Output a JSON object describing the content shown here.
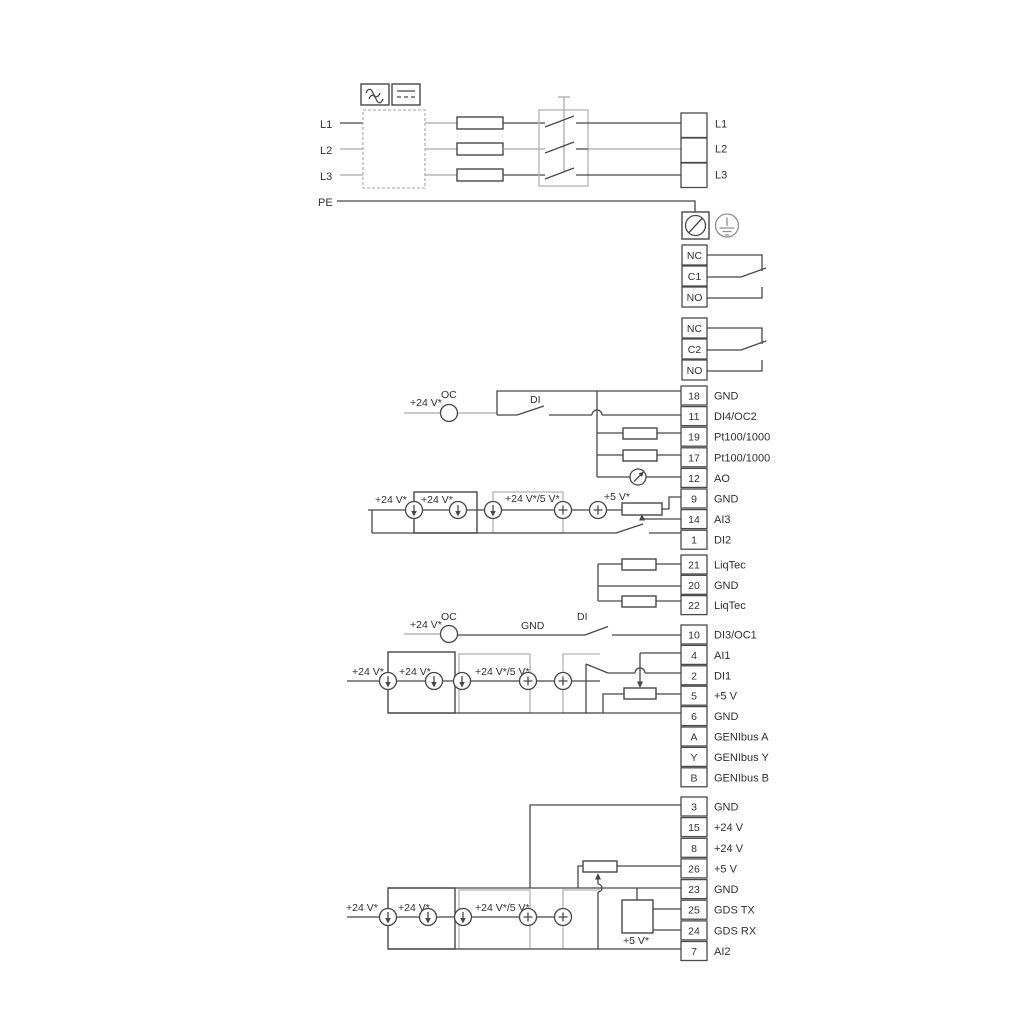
{
  "power": {
    "left": [
      "L1",
      "L2",
      "L3",
      "PE"
    ],
    "right": [
      "L1",
      "L2",
      "L3"
    ]
  },
  "relays": {
    "relay1": [
      "NC",
      "C1",
      "NO"
    ],
    "relay2": [
      "NC",
      "C2",
      "NO"
    ]
  },
  "io1": {
    "rows": [
      {
        "num": "18",
        "label": "GND"
      },
      {
        "num": "11",
        "label": "DI4/OC2"
      },
      {
        "num": "19",
        "label": "Pt100/1000"
      },
      {
        "num": "17",
        "label": "Pt100/1000"
      },
      {
        "num": "12",
        "label": "AO"
      },
      {
        "num": "9",
        "label": "GND"
      },
      {
        "num": "14",
        "label": "AI3"
      },
      {
        "num": "1",
        "label": "DI2"
      }
    ]
  },
  "liqtec": {
    "rows": [
      {
        "num": "21",
        "label": "LiqTec"
      },
      {
        "num": "20",
        "label": "GND"
      },
      {
        "num": "22",
        "label": "LiqTec"
      }
    ]
  },
  "io2": {
    "rows": [
      {
        "num": "10",
        "label": "DI3/OC1"
      },
      {
        "num": "4",
        "label": "AI1"
      },
      {
        "num": "2",
        "label": "DI1"
      },
      {
        "num": "5",
        "label": "+5 V"
      },
      {
        "num": "6",
        "label": "GND"
      },
      {
        "num": "A",
        "label": "GENIbus A"
      },
      {
        "num": "Y",
        "label": "GENIbus Y"
      },
      {
        "num": "B",
        "label": "GENIbus B"
      }
    ]
  },
  "io3": {
    "rows": [
      {
        "num": "3",
        "label": "GND"
      },
      {
        "num": "15",
        "label": "+24 V"
      },
      {
        "num": "8",
        "label": "+24 V"
      },
      {
        "num": "26",
        "label": "+5 V"
      },
      {
        "num": "23",
        "label": "GND"
      },
      {
        "num": "25",
        "label": "GDS TX"
      },
      {
        "num": "24",
        "label": "GDS RX"
      },
      {
        "num": "7",
        "label": "AI2"
      }
    ]
  },
  "ann": {
    "c1": {
      "v24": "+24 V*",
      "oc": "OC",
      "di": "DI"
    },
    "ai3": {
      "v24a": "+24 V*",
      "v24b": "+24 V*",
      "v245": "+24 V*/5 V*",
      "v5": "+5 V*"
    },
    "c3": {
      "v24": "+24 V*",
      "oc": "OC",
      "gnd": "GND",
      "di": "DI"
    },
    "ai1": {
      "v24a": "+24 V*",
      "v24b": "+24 V*",
      "v245": "+24 V*/5 V*"
    },
    "ai2": {
      "v24a": "+24 V*",
      "v24b": "+24 V*",
      "v245": "+24 V*/5 V*",
      "v5": "+5 V*"
    }
  },
  "colors": {
    "wire": "#474747",
    "grey_wire": "#a9a9a9",
    "bracket": "#b4b4b4",
    "background": "#ffffff"
  }
}
